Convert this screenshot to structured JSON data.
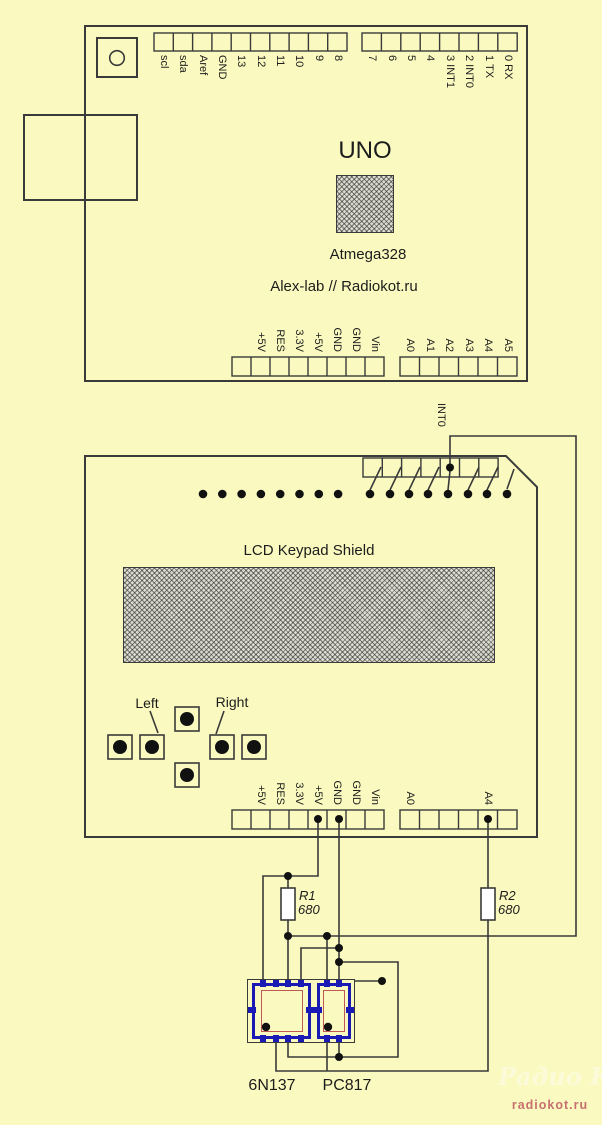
{
  "colors": {
    "background": "#FAFAC0",
    "line": "#3a3a3a",
    "chip_blue": "#1a1ab4",
    "chip_red": "#c05858",
    "resistor_fill": "#ffffff",
    "watermark_site": "#c87070",
    "watermark_logo": "#fbfbda"
  },
  "uno": {
    "title": "UNO",
    "chip_label": "Atmega328",
    "credit": "Alex-lab // Radiokot.ru",
    "top_left_pins": [
      "scl",
      "sda",
      "Aref",
      "GND",
      "13",
      "12",
      "11",
      "10",
      "9",
      "8"
    ],
    "top_right_pins": [
      "7",
      "6",
      "5",
      "4",
      "3 INT1",
      "2 INT0",
      "1 TX",
      "0 RX"
    ],
    "power_pins": [
      "",
      "+5V",
      "RES",
      "3.3V",
      "+5V",
      "GND",
      "GND",
      "Vin"
    ],
    "analog_pins": [
      "A0",
      "A1",
      "A2",
      "A3",
      "A4",
      "A5"
    ]
  },
  "shield": {
    "title": "LCD Keypad Shield",
    "int0_label": "INT0",
    "power_pins": [
      "",
      "+5V",
      "RES",
      "3.3V",
      "+5V",
      "GND",
      "GND",
      "Vin"
    ],
    "analog_pins": [
      "A0",
      "",
      "",
      "",
      "A4",
      ""
    ],
    "buttons": {
      "left_label": "Left",
      "right_label": "Right"
    }
  },
  "components": {
    "r1": {
      "name": "R1",
      "value": "680"
    },
    "r2": {
      "name": "R2",
      "value": "680"
    },
    "opto1": "6N137",
    "opto2": "PC817"
  },
  "watermark": {
    "logo": "Радио КОТ",
    "site": "radiokot.ru"
  }
}
